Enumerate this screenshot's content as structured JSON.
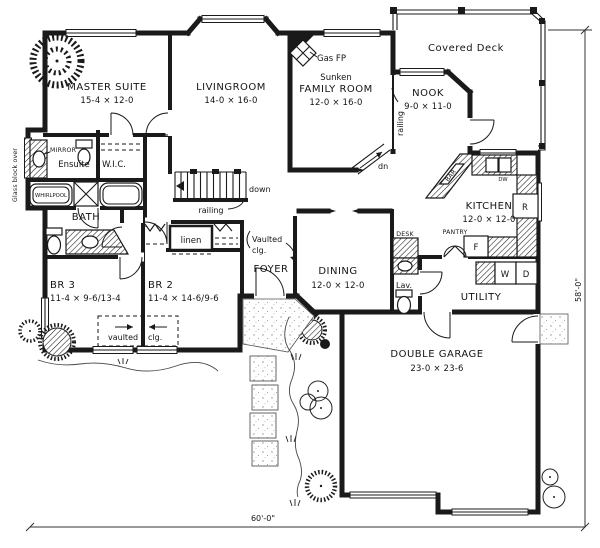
{
  "plan": {
    "rooms": {
      "master_suite": {
        "name": "MASTER SUITE",
        "dims": "15-4 × 12-0"
      },
      "livingroom": {
        "name": "LIVINGROOM",
        "dims": "14-0 × 16-0"
      },
      "family_room": {
        "prefix": "Sunken",
        "name": "FAMILY ROOM",
        "dims": "12-0 × 16-0"
      },
      "nook": {
        "name": "NOOK",
        "dims": "9-0 × 11-0"
      },
      "covered_deck": {
        "name": "Covered Deck"
      },
      "kitchen": {
        "name": "KITCHEN",
        "dims": "12-0 × 12-0"
      },
      "dining": {
        "name": "DINING",
        "dims": "12-0 × 12-0"
      },
      "foyer": {
        "name": "FOYER"
      },
      "utility": {
        "name": "UTILITY"
      },
      "bath": {
        "name": "BATH"
      },
      "ensuite": {
        "name": "Ensuite"
      },
      "wic": {
        "name": "W.I.C."
      },
      "br2": {
        "name": "BR 2",
        "dims": "11-4 × 14-6/9-6"
      },
      "br3": {
        "name": "BR 3",
        "dims": "11-4 × 9-6/13-4"
      },
      "lav": {
        "name": "Lav."
      },
      "garage": {
        "name": "DOUBLE GARAGE",
        "dims": "23-0 × 23-6"
      }
    },
    "labels": {
      "gas_fp": "Gas FP",
      "mirror": "MIRROR",
      "whirlpool": "WHIRLPOOL",
      "linen": "linen",
      "desk": "DESK",
      "pantry": "PANTRY",
      "bar": "BAR",
      "dishwasher": "DW",
      "range": "R",
      "freezer": "F",
      "washer": "W",
      "dryer": "D",
      "down": "down",
      "dn": "dn",
      "railing_stairs": "railing",
      "railing_nook": "railing",
      "vaulted_foyer_line1": "Vaulted",
      "vaulted_foyer_line2": "clg.",
      "vaulted_br_line1": "vaulted",
      "vaulted_br_line2": "clg.",
      "glass_block": "Glass block over"
    },
    "dimensions": {
      "overall_width": "60'-0\"",
      "overall_depth": "58'-0\""
    },
    "colors": {
      "ink": "#141414",
      "paper": "#ffffff"
    }
  }
}
